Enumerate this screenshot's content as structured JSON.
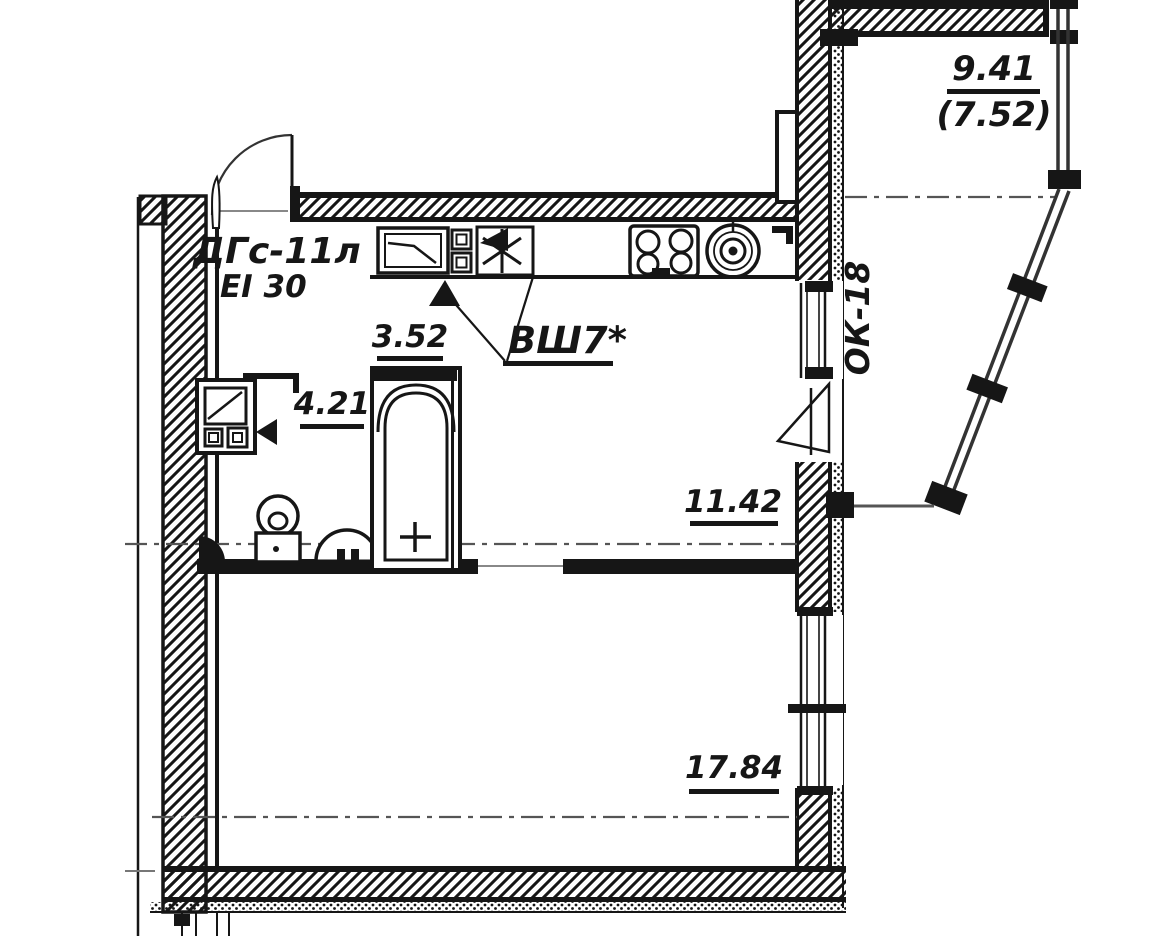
{
  "drawing": {
    "type": "apartment-floor-plan",
    "ink_color": "#161616",
    "axis_color": "#555555",
    "background": "#ffffff",
    "labels": {
      "door_mark": "ДГс-11л",
      "fire_rating": "EI 30",
      "vent_mark": "ВШ7*",
      "window_mark": "ОК-18"
    },
    "areas": [
      {
        "name": "balcony-area-total",
        "value": "9.41"
      },
      {
        "name": "balcony-area-counted",
        "value": "(7.52)"
      },
      {
        "name": "area-352",
        "value": "3.52"
      },
      {
        "name": "area-421",
        "value": "4.21"
      },
      {
        "name": "area-1142",
        "value": "11.42"
      },
      {
        "name": "area-1784",
        "value": "17.84"
      }
    ]
  }
}
